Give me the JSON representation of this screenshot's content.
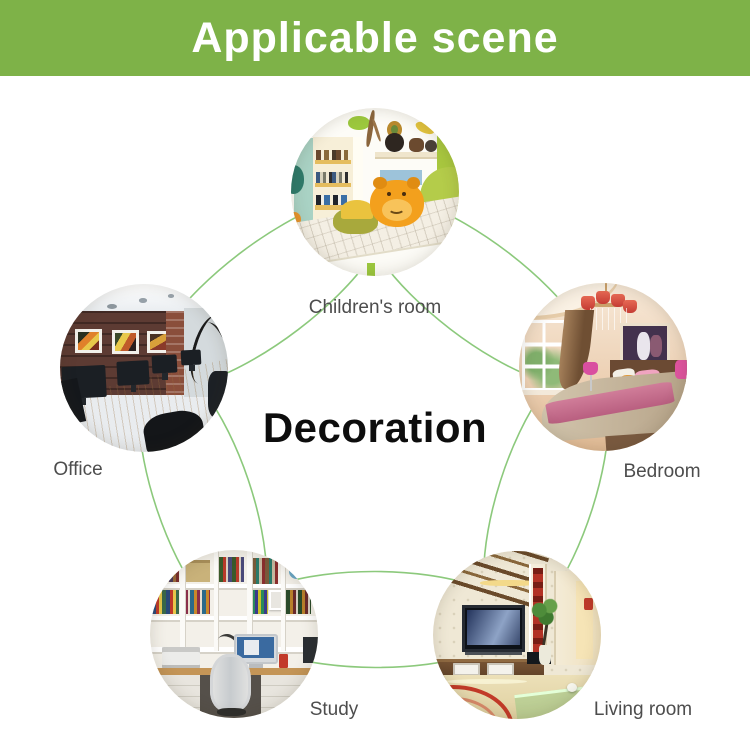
{
  "banner": {
    "title": "Applicable scene"
  },
  "center_label": "Decoration",
  "colors": {
    "banner_green": "#7eb248",
    "link_green": "#8cc97c",
    "ring_green": "#77c25e",
    "label_gray": "#4d4d4d",
    "center_text": "#0d0d0d"
  },
  "scenes": [
    {
      "id": "children-room",
      "label": "Children's room"
    },
    {
      "id": "office",
      "label": "Office"
    },
    {
      "id": "bedroom",
      "label": "Bedroom"
    },
    {
      "id": "study",
      "label": "Study"
    },
    {
      "id": "living-room",
      "label": "Living room"
    }
  ]
}
